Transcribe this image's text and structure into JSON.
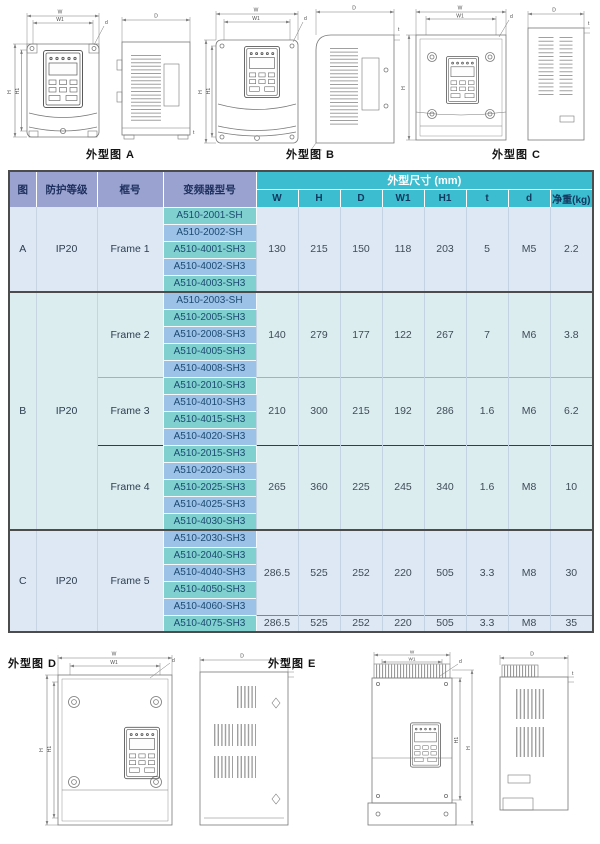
{
  "captions": {
    "a": "外型图 A",
    "b": "外型图 B",
    "c": "外型图 C",
    "d": "外型图 D",
    "e": "外型图 E"
  },
  "dims": {
    "w": "W",
    "w1": "W1",
    "h": "H",
    "h1": "H1",
    "depth": "D",
    "hole": "d",
    "t": "t"
  },
  "table": {
    "headers": {
      "fig": "图",
      "protection": "防护等级",
      "frame": "框号",
      "model": "变频器型号",
      "size_group": "外型尺寸 (mm)",
      "cols": [
        "W",
        "H",
        "D",
        "W1",
        "H1",
        "t",
        "d",
        "净重(kg)"
      ]
    },
    "sections": [
      {
        "fig": "A",
        "protection": "IP20",
        "groups": [
          {
            "frame": "Frame 1",
            "models": [
              "A510-2001-SH",
              "A510-2002-SH",
              "A510-4001-SH3",
              "A510-4002-SH3",
              "A510-4003-SH3"
            ],
            "values": [
              "130",
              "215",
              "150",
              "118",
              "203",
              "5",
              "M5",
              "2.2"
            ]
          }
        ]
      },
      {
        "fig": "B",
        "protection": "IP20",
        "groups": [
          {
            "frame": "Frame 2",
            "models": [
              "A510-2003-SH",
              "A510-2005-SH3",
              "A510-2008-SH3",
              "A510-4005-SH3",
              "A510-4008-SH3"
            ],
            "values": [
              "140",
              "279",
              "177",
              "122",
              "267",
              "7",
              "M6",
              "3.8"
            ]
          },
          {
            "frame": "Frame 3",
            "models": [
              "A510-2010-SH3",
              "A510-4010-SH3",
              "A510-4015-SH3",
              "A510-4020-SH3"
            ],
            "values": [
              "210",
              "300",
              "215",
              "192",
              "286",
              "1.6",
              "M6",
              "6.2"
            ]
          },
          {
            "frame": "Frame 4",
            "models": [
              "A510-2015-SH3",
              "A510-2020-SH3",
              "A510-2025-SH3",
              "A510-4025-SH3",
              "A510-4030-SH3"
            ],
            "values": [
              "265",
              "360",
              "225",
              "245",
              "340",
              "1.6",
              "M8",
              "10"
            ]
          }
        ]
      },
      {
        "fig": "C",
        "protection": "IP20",
        "groups": [
          {
            "frame": "Frame 5",
            "models": [
              "A510-2030-SH3",
              "A510-2040-SH3",
              "A510-4040-SH3",
              "A510-4050-SH3",
              "A510-4060-SH3"
            ],
            "values": [
              "286.5",
              "525",
              "252",
              "220",
              "505",
              "3.3",
              "M8",
              "30"
            ]
          },
          {
            "frame": "",
            "models": [
              "A510-4075-SH3"
            ],
            "values": [
              "286.5",
              "525",
              "252",
              "220",
              "505",
              "3.3",
              "M8",
              "35"
            ]
          }
        ]
      }
    ]
  },
  "colors": {
    "header_purple": "#9aa2cf",
    "header_teal": "#3dbdd0",
    "model_teal": "#80d0d0",
    "model_blue": "#9dc2e7",
    "section_blue_bg": "#dde8f4",
    "section_cyan_bg": "#dcedf0",
    "drawing_stroke": "#787878"
  }
}
